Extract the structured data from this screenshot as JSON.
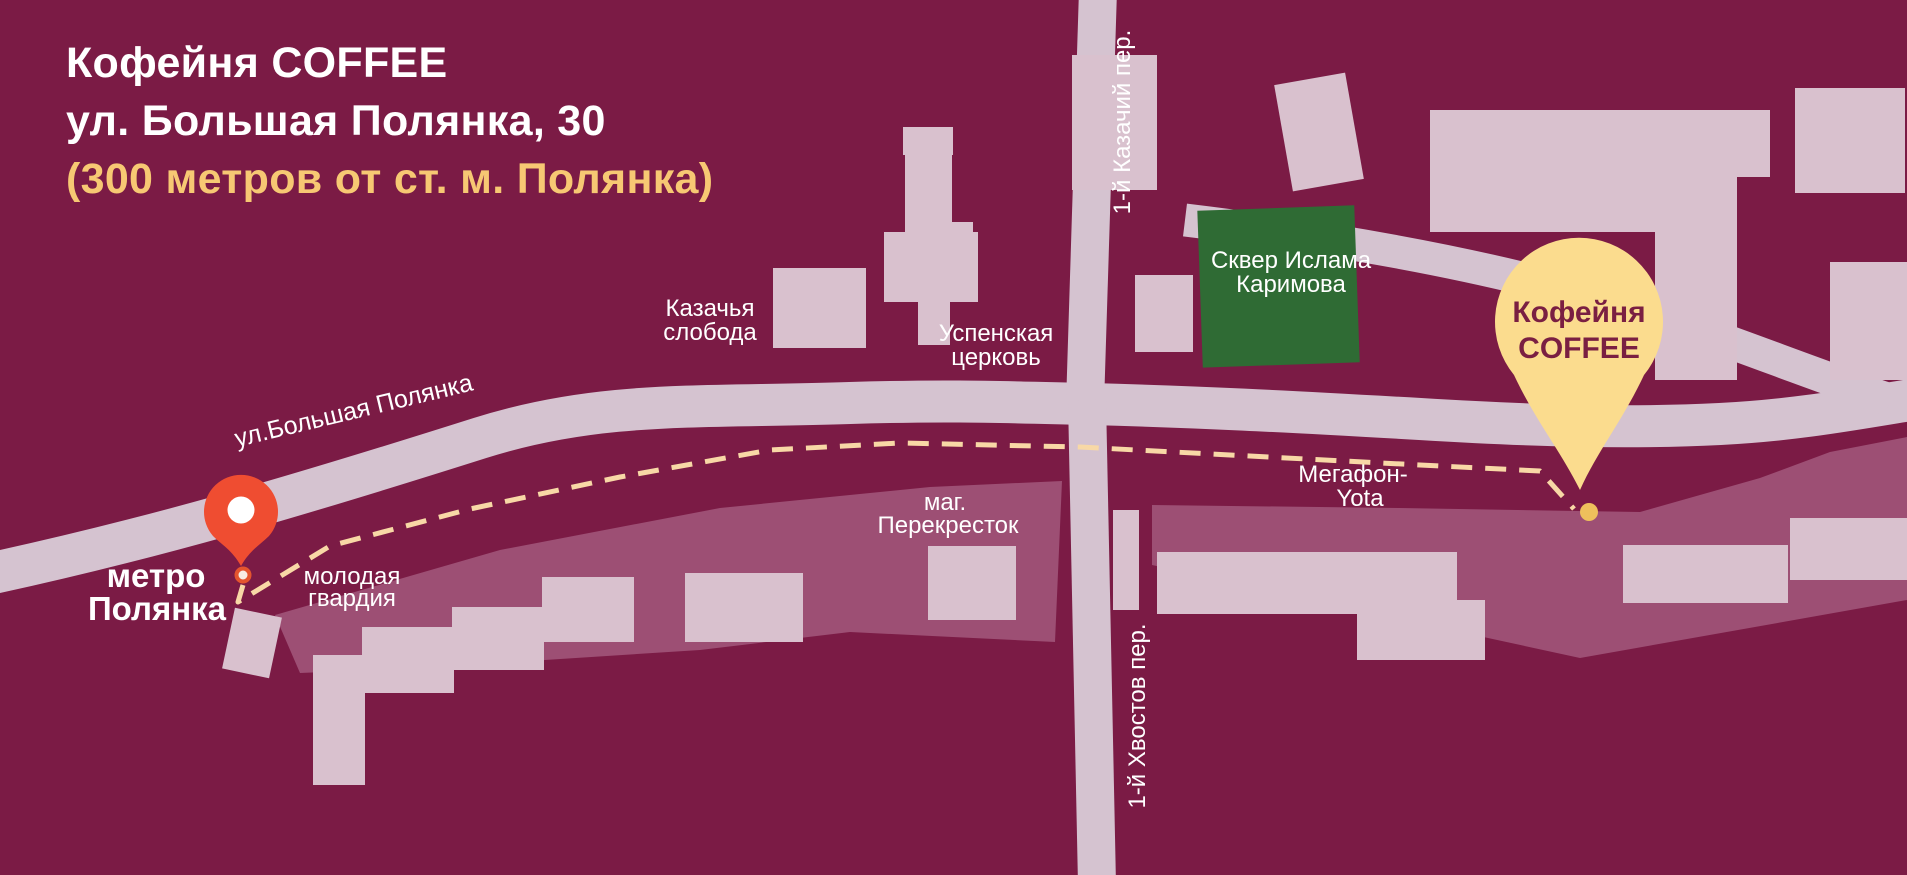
{
  "header": {
    "title_line1": "Кофейня COFFEE",
    "title_line2": "ул. Большая Полянка, 30",
    "subtitle": "(300 метров от ст. м. Полянка)"
  },
  "map": {
    "streets": {
      "main": "ул.Большая Полянка",
      "north_lane": "1-й Казачий пер.",
      "south_lane": "1-й Хвостов пер."
    },
    "places": {
      "metro_line1": "метро",
      "metro_line2": "Полянка",
      "sloboda_line1": "Казачья",
      "sloboda_line2": "слобода",
      "church_line1": "Успенская",
      "church_line2": "церковь",
      "park_line1": "Сквер Ислама",
      "park_line2": "Каримова",
      "store_line1": "маг.",
      "store_line2": "Перекресток",
      "guard_line1": "молодая",
      "guard_line2": "гвардия",
      "megafon_line1": "Мегафон-",
      "megafon_line2": "Yota"
    },
    "coffee_pin": {
      "line1": "Кофейня",
      "line2": "COFFEE"
    }
  },
  "colors": {
    "bg": "#7B1B45",
    "road": "#D5C3D0",
    "building": "#D9C1CE",
    "block": "#9D4F74",
    "park": "#2F6B34",
    "route": "#F8D8A6",
    "route_dot": "#EEC05C",
    "metro_pin": "#EF4D31",
    "metro_pin_center": "#FFFFFF",
    "coffee_pin": "#FBDC8E",
    "pin_text": "#7A1F42",
    "heading_text": "#FFFFFF",
    "heading_accent": "#F7C873",
    "label_text": "#FFFFFF"
  }
}
